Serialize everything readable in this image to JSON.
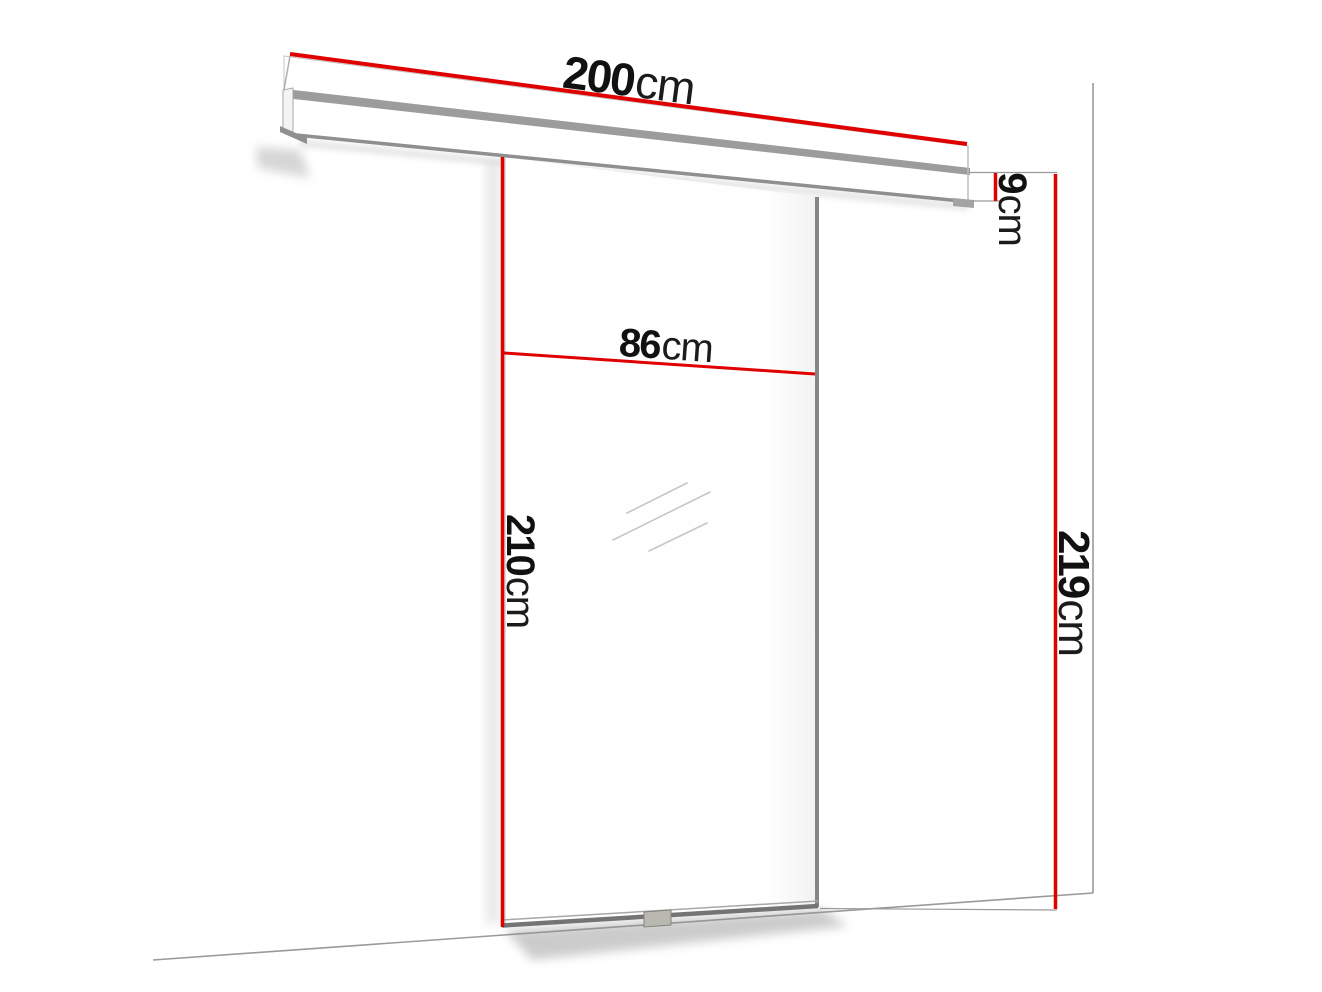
{
  "diagram": {
    "type": "technical-dimension-diagram",
    "subject": "sliding glass door on wall-mounted rail",
    "labels": {
      "rail_width": {
        "value": "200",
        "unit": "cm"
      },
      "door_width": {
        "value": "86",
        "unit": "cm"
      },
      "door_height": {
        "value": "210",
        "unit": "cm"
      },
      "rail_height": {
        "value": "9",
        "unit": "cm"
      },
      "total_height": {
        "value": "219",
        "unit": "cm"
      }
    },
    "colors": {
      "dimension_red": "#e10000",
      "line_gray": "#9a9a9a",
      "edge_dark": "#757575",
      "label_text": "#111111",
      "background": "#ffffff"
    }
  }
}
